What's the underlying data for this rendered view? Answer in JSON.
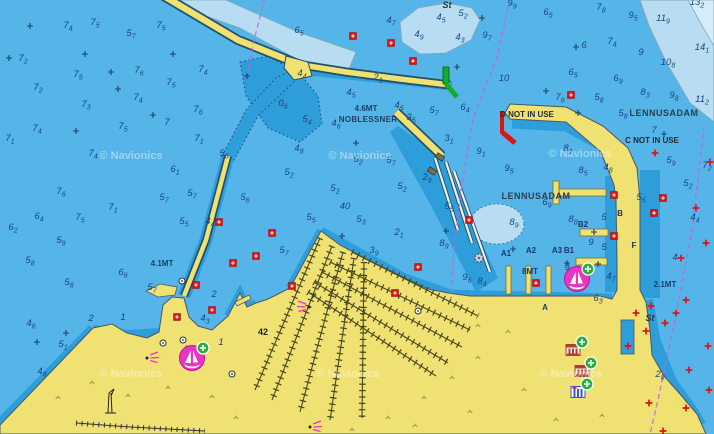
{
  "map": {
    "attribution": "© Navionics",
    "place_labels": [
      {
        "t": "St",
        "x": 447,
        "y": 8,
        "cls": "seabed"
      },
      {
        "t": "St",
        "x": 650,
        "y": 321,
        "cls": "seabed"
      },
      {
        "t": "4.6MT",
        "x": 366,
        "y": 111,
        "cls": "limit"
      },
      {
        "t": "NOBLESSNER",
        "x": 368,
        "y": 122,
        "cls": "place-sm"
      },
      {
        "t": "D NOT IN USE",
        "x": 527,
        "y": 117,
        "cls": "notice"
      },
      {
        "t": "C NOT IN USE",
        "x": 652,
        "y": 143,
        "cls": "notice"
      },
      {
        "t": "LENNUSADAM",
        "x": 664,
        "y": 116,
        "cls": "place"
      },
      {
        "t": "LENNUSADAM",
        "x": 536,
        "y": 199,
        "cls": "place"
      },
      {
        "t": "4.1MT",
        "x": 162,
        "y": 266,
        "cls": "limit"
      },
      {
        "t": "8MT",
        "x": 530,
        "y": 274,
        "cls": "limit"
      },
      {
        "t": "2.1MT",
        "x": 665,
        "y": 287,
        "cls": "limit"
      },
      {
        "t": "42",
        "x": 263,
        "y": 335,
        "cls": "land"
      },
      {
        "t": "B2",
        "x": 583,
        "y": 227,
        "cls": "dock"
      },
      {
        "t": "A1",
        "x": 506,
        "y": 256,
        "cls": "dock"
      },
      {
        "t": "A2",
        "x": 531,
        "y": 253,
        "cls": "dock"
      },
      {
        "t": "A3",
        "x": 557,
        "y": 253,
        "cls": "dock"
      },
      {
        "t": "B1",
        "x": 569,
        "y": 253,
        "cls": "dock"
      },
      {
        "t": "B",
        "x": 620,
        "y": 216,
        "cls": "dock"
      },
      {
        "t": "F",
        "x": 634,
        "y": 248,
        "cls": "dock"
      },
      {
        "t": "A",
        "x": 545,
        "y": 310,
        "cls": "dock"
      }
    ],
    "depth_soundings": [
      [
        "7",
        "4",
        68,
        28
      ],
      [
        "7",
        "5",
        95,
        25
      ],
      [
        "5",
        "7",
        131,
        36
      ],
      [
        "7",
        "5",
        161,
        28
      ],
      [
        "7",
        "2",
        23,
        61
      ],
      [
        "7",
        "5",
        78,
        77
      ],
      [
        "7",
        "6",
        139,
        73
      ],
      [
        "7",
        "4",
        203,
        72
      ],
      [
        "7",
        "2",
        38,
        90
      ],
      [
        "7",
        "5",
        171,
        85
      ],
      [
        "7",
        "3",
        86,
        107
      ],
      [
        "7",
        "4",
        138,
        100
      ],
      [
        "7",
        "6",
        198,
        112
      ],
      [
        "7",
        "4",
        37,
        131
      ],
      [
        "7",
        "5",
        123,
        129
      ],
      [
        "7",
        "",
        167,
        125
      ],
      [
        "7",
        "1",
        10,
        141
      ],
      [
        "7",
        "1",
        199,
        141
      ],
      [
        "6",
        "5",
        299,
        33
      ],
      [
        "4",
        "7",
        391,
        23
      ],
      [
        "5",
        "2",
        463,
        16
      ],
      [
        "4",
        "5",
        441,
        20
      ],
      [
        "4",
        "9",
        419,
        37
      ],
      [
        "4",
        "3",
        460,
        40
      ],
      [
        "9",
        "9",
        512,
        6
      ],
      [
        "9",
        "7",
        487,
        38
      ],
      [
        "10",
        "",
        504,
        81
      ],
      [
        "6",
        "5",
        548,
        15
      ],
      [
        "7",
        "8",
        601,
        10
      ],
      [
        "9",
        "5",
        633,
        18
      ],
      [
        "11",
        "9",
        663,
        21
      ],
      [
        "13",
        "2",
        697,
        5
      ],
      [
        "7",
        "4",
        612,
        44
      ],
      [
        "6",
        "",
        584,
        48
      ],
      [
        "9",
        "",
        641,
        55
      ],
      [
        "14",
        "1",
        702,
        50
      ],
      [
        "10",
        "8",
        668,
        65
      ],
      [
        "6",
        "5",
        573,
        75
      ],
      [
        "6",
        "9",
        618,
        81
      ],
      [
        "8",
        "3",
        645,
        95
      ],
      [
        "9",
        "8",
        674,
        98
      ],
      [
        "11",
        "2",
        702,
        102
      ],
      [
        "7",
        "6",
        560,
        100
      ],
      [
        "5",
        "8",
        599,
        100
      ],
      [
        "5",
        "8",
        623,
        116
      ],
      [
        "7",
        "",
        654,
        133
      ],
      [
        "5",
        "9",
        671,
        163
      ],
      [
        "7",
        "2",
        707,
        168
      ],
      [
        "5",
        "2",
        688,
        186
      ],
      [
        "5",
        "5",
        641,
        200
      ],
      [
        "4",
        "8",
        608,
        170
      ],
      [
        "4",
        "4",
        302,
        76
      ],
      [
        "2",
        "1",
        378,
        80
      ],
      [
        "4",
        "5",
        351,
        95
      ],
      [
        "4",
        "5",
        399,
        108
      ],
      [
        "0",
        "6",
        283,
        106
      ],
      [
        "5",
        "4",
        307,
        122
      ],
      [
        "4",
        "6",
        336,
        126
      ],
      [
        "5",
        "7",
        434,
        113
      ],
      [
        "3",
        "5",
        411,
        120
      ],
      [
        "6",
        "4",
        465,
        110
      ],
      [
        "3",
        "1",
        449,
        141
      ],
      [
        "9",
        "1",
        481,
        154
      ],
      [
        "8",
        "1",
        568,
        151
      ],
      [
        "9",
        "5",
        509,
        171
      ],
      [
        "8",
        "5",
        583,
        173
      ],
      [
        "7",
        "4",
        93,
        156
      ],
      [
        "6",
        "1",
        175,
        172
      ],
      [
        "7",
        "6",
        61,
        194
      ],
      [
        "5",
        "7",
        164,
        200
      ],
      [
        "5",
        "7",
        192,
        196
      ],
      [
        "7",
        "1",
        113,
        210
      ],
      [
        "6",
        "4",
        39,
        219
      ],
      [
        "7",
        "5",
        80,
        220
      ],
      [
        "5",
        "5",
        184,
        224
      ],
      [
        "6",
        "2",
        13,
        230
      ],
      [
        "4",
        "4",
        210,
        224
      ],
      [
        "5",
        "9",
        61,
        243
      ],
      [
        "5",
        "8",
        30,
        263
      ],
      [
        "5",
        "6",
        224,
        156
      ],
      [
        "5",
        "8",
        69,
        285
      ],
      [
        "6",
        "6",
        123,
        275
      ],
      [
        "5",
        "7",
        152,
        290
      ],
      [
        "4",
        "8",
        299,
        151
      ],
      [
        "5",
        "2",
        358,
        162
      ],
      [
        "5",
        "7",
        391,
        163
      ],
      [
        "5",
        "2",
        289,
        175
      ],
      [
        "5",
        "2",
        335,
        191
      ],
      [
        "5",
        "2",
        402,
        189
      ],
      [
        "2",
        "9",
        427,
        180
      ],
      [
        "40",
        "",
        345,
        209
      ],
      [
        "5",
        "3",
        361,
        222
      ],
      [
        "5",
        "5",
        311,
        220
      ],
      [
        "5",
        "6",
        245,
        200
      ],
      [
        "5",
        "5",
        449,
        209
      ],
      [
        "2",
        "1",
        399,
        235
      ],
      [
        "5",
        "7",
        284,
        253
      ],
      [
        "3",
        "9",
        374,
        253
      ],
      [
        "8",
        "9",
        444,
        246
      ],
      [
        "9",
        "6",
        467,
        280
      ],
      [
        "6",
        "9",
        547,
        205
      ],
      [
        "8",
        "9",
        514,
        225
      ],
      [
        "8",
        "8",
        573,
        222
      ],
      [
        "5",
        "",
        604,
        220
      ],
      [
        "4",
        "4",
        695,
        220
      ],
      [
        "9",
        "",
        591,
        245
      ],
      [
        "5",
        "",
        604,
        250
      ],
      [
        "4",
        "",
        675,
        260
      ],
      [
        "9",
        "2",
        569,
        270
      ],
      [
        "4",
        "7",
        611,
        279
      ],
      [
        "8",
        "4",
        482,
        284
      ],
      [
        "6",
        "3",
        598,
        301
      ],
      [
        "2",
        "8",
        660,
        377
      ],
      [
        "4",
        "6",
        31,
        326
      ],
      [
        "5",
        "1",
        63,
        347
      ],
      [
        "4",
        "8",
        42,
        374
      ],
      [
        "4",
        "3",
        205,
        321
      ],
      [
        "4",
        "2",
        187,
        352
      ],
      [
        "1",
        "",
        221,
        345
      ],
      [
        "2",
        "",
        91,
        321
      ],
      [
        "1",
        "",
        123,
        320
      ],
      [
        "2",
        "",
        214,
        297
      ]
    ],
    "position_crosses": [
      [
        30,
        26
      ],
      [
        85,
        54
      ],
      [
        9,
        58
      ],
      [
        173,
        54
      ],
      [
        111,
        72
      ],
      [
        118,
        89
      ],
      [
        76,
        131
      ],
      [
        153,
        115
      ],
      [
        247,
        76
      ],
      [
        482,
        18
      ],
      [
        546,
        91
      ],
      [
        576,
        47
      ],
      [
        664,
        134
      ],
      [
        342,
        236
      ],
      [
        446,
        231
      ],
      [
        37,
        342
      ],
      [
        66,
        333
      ],
      [
        567,
        263
      ],
      [
        598,
        264
      ],
      [
        584,
        287
      ],
      [
        513,
        249
      ],
      [
        594,
        232
      ],
      [
        457,
        67
      ],
      [
        356,
        143
      ],
      [
        578,
        113
      ]
    ],
    "hazard_red_boxes": [
      [
        353,
        36
      ],
      [
        391,
        43
      ],
      [
        413,
        61
      ],
      [
        571,
        95
      ],
      [
        219,
        222
      ],
      [
        233,
        263
      ],
      [
        196,
        285
      ],
      [
        272,
        233
      ],
      [
        256,
        256
      ],
      [
        292,
        286
      ],
      [
        418,
        267
      ],
      [
        469,
        220
      ],
      [
        614,
        195
      ],
      [
        614,
        236
      ],
      [
        536,
        283
      ],
      [
        654,
        213
      ],
      [
        663,
        198
      ],
      [
        177,
        317
      ],
      [
        212,
        310
      ],
      [
        395,
        293
      ]
    ],
    "hazard_red_crosses": [
      [
        651,
        306
      ],
      [
        686,
        300
      ],
      [
        676,
        313
      ],
      [
        646,
        331
      ],
      [
        665,
        323
      ],
      [
        708,
        346
      ],
      [
        649,
        403
      ],
      [
        686,
        408
      ],
      [
        663,
        431
      ],
      [
        709,
        390
      ],
      [
        689,
        370
      ],
      [
        636,
        313
      ],
      [
        628,
        346
      ],
      [
        655,
        153
      ],
      [
        696,
        208
      ],
      [
        706,
        243
      ],
      [
        681,
        258
      ],
      [
        710,
        162
      ]
    ],
    "minor_lights": [
      [
        182,
        281
      ],
      [
        163,
        343
      ],
      [
        183,
        340
      ],
      [
        232,
        374
      ],
      [
        418,
        311
      ]
    ],
    "light_flares": [
      {
        "x": 147,
        "y": 358,
        "dir": "e"
      },
      {
        "x": 309,
        "y": 307,
        "dir": "w"
      },
      {
        "x": 310,
        "y": 427,
        "dir": "e"
      }
    ],
    "cranes": [
      [
        440,
        157
      ],
      [
        432,
        171
      ]
    ],
    "wreck_gears": [
      [
        479,
        258
      ]
    ],
    "vegetation_tufts": [
      [
        58,
        398
      ],
      [
        92,
        383
      ],
      [
        128,
        396
      ],
      [
        168,
        388
      ],
      [
        212,
        397
      ],
      [
        236,
        418
      ],
      [
        388,
        418
      ],
      [
        424,
        398
      ],
      [
        452,
        378
      ],
      [
        478,
        358
      ],
      [
        470,
        412
      ],
      [
        508,
        332
      ],
      [
        524,
        390
      ],
      [
        556,
        420
      ],
      [
        602,
        416
      ],
      [
        478,
        326
      ],
      [
        352,
        430
      ],
      [
        415,
        426
      ]
    ],
    "marina_icons": [
      [
        577,
        279
      ],
      [
        192,
        358
      ]
    ],
    "poi_buildings": [
      {
        "x": 573,
        "y": 350,
        "kind": "museum"
      },
      {
        "x": 582,
        "y": 371,
        "kind": "museum"
      },
      {
        "x": 578,
        "y": 392,
        "kind": "office"
      }
    ],
    "watermarks": [
      [
        131,
        159
      ],
      [
        360,
        159
      ],
      [
        580,
        157
      ],
      [
        131,
        377
      ],
      [
        348,
        377
      ],
      [
        571,
        377
      ]
    ]
  },
  "colors": {
    "water_mid": "#56b5e8",
    "water_shallow": "#2e9edb",
    "water_deep": "#b8ddf2",
    "water_deepest": "#d5ecf9",
    "land": "#f0e173",
    "route_magenta": "#c361d6",
    "hazard_red": "#e01212",
    "beacon_green": "#13ad2b",
    "marina_magenta": "#ea35c4",
    "badge_green": "#27b03c",
    "sounding_text": "#16467e"
  }
}
